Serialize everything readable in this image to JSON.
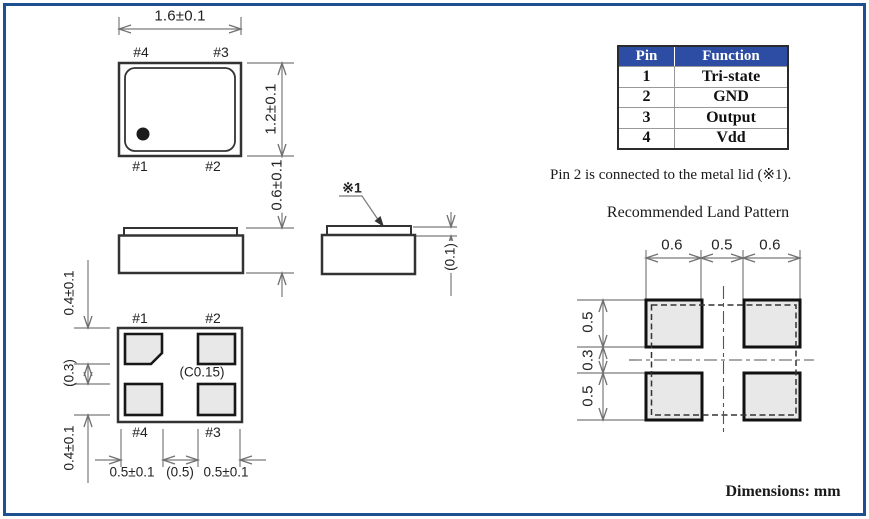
{
  "views": {
    "top": {
      "dim_w": "1.6±0.1",
      "dim_h": "1.2±0.1",
      "pins": {
        "tl": "#4",
        "tr": "#3",
        "bl": "#1",
        "br": "#2"
      }
    },
    "side": {
      "dim_h": "0.6±0.1"
    },
    "end": {
      "ref": "※1",
      "dim_lid": "(0.1)"
    },
    "bottom": {
      "pins": {
        "tl": "#1",
        "tr": "#2",
        "bl": "#4",
        "br": "#3"
      },
      "chamfer": "(C0.15)",
      "left_dims": [
        "0.4±0.1",
        "(0.3)",
        "0.4±0.1"
      ],
      "bottom_dims": [
        "0.5±0.1",
        "(0.5)",
        "0.5±0.1"
      ]
    }
  },
  "pin_table": {
    "headers": [
      "Pin",
      "Function"
    ],
    "rows": [
      [
        "1",
        "Tri-state"
      ],
      [
        "2",
        "GND"
      ],
      [
        "3",
        "Output"
      ],
      [
        "4",
        "Vdd"
      ]
    ]
  },
  "note": "Pin 2 is connected to the metal lid (※1).",
  "land_pattern": {
    "title": "Recommended Land Pattern",
    "top_dims": [
      "0.6",
      "0.5",
      "0.6"
    ],
    "left_dims": [
      "0.5",
      "0.3",
      "0.5"
    ]
  },
  "footer": "Dimensions: mm",
  "colors": {
    "frame": "#1e4f91",
    "table_header": "#2c4da3",
    "pad_fill": "#e8e8e8",
    "object_line": "#333333",
    "dim_line": "#7a7a7a"
  }
}
